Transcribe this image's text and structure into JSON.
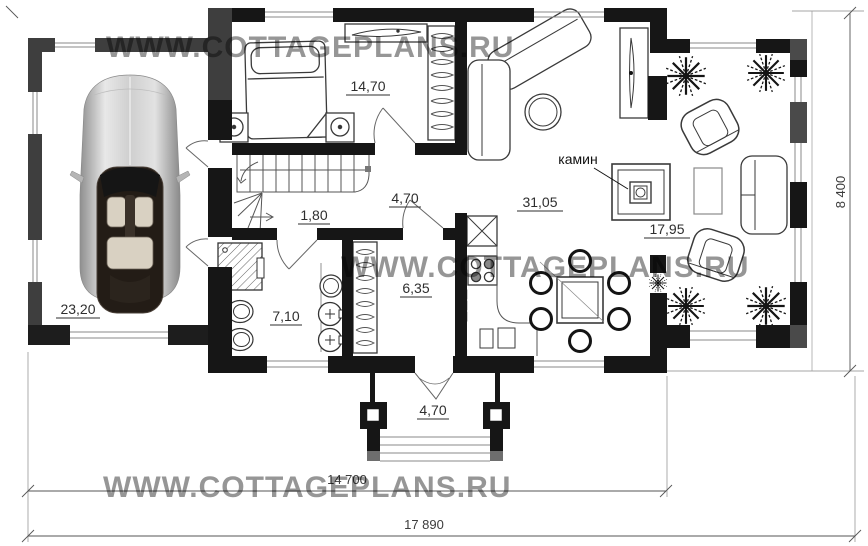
{
  "plan": {
    "watermark": "WWW.COTTAGEPLANS.RU",
    "rooms": {
      "garage": "23,20",
      "bedroom": "14,70",
      "stairs": "1,80",
      "hall": "4,70",
      "living": "31,05",
      "lounge": "17,95",
      "bathroom": "7,10",
      "dressing": "6,35",
      "porch": "4,70"
    },
    "fireplace_label": "камин",
    "dimensions": {
      "inner_width": "14 700",
      "total_width": "17 890",
      "depth": "8 400"
    },
    "colors": {
      "wall": "#161616",
      "garage_wall": "#3e3e3e",
      "pier": "#4a4a4a",
      "watermark": "#969696"
    }
  }
}
